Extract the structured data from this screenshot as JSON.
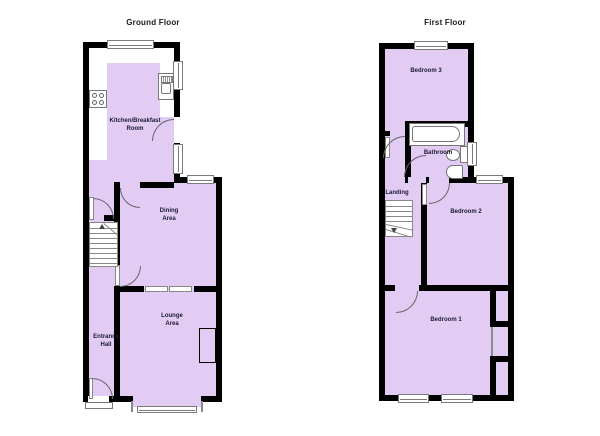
{
  "colors": {
    "room_fill": "#E3CCF3",
    "wall": "#000000",
    "fixture_outline": "#777777",
    "label_text": "#1A1A33"
  },
  "ground_floor": {
    "title": "Ground Floor",
    "rooms": {
      "kitchen": {
        "line1": "Kitchen/Breakfast",
        "line2": "Room"
      },
      "dining": {
        "line1": "Dining",
        "line2": "Area"
      },
      "lounge": {
        "line1": "Lounge",
        "line2": "Area"
      },
      "hall": {
        "line1": "Entrance",
        "line2": "Hall"
      }
    },
    "fixtures": [
      "hob",
      "sink-unit",
      "staircase",
      "bay-window",
      "entrance-door",
      "chimney-breast"
    ]
  },
  "first_floor": {
    "title": "First Floor",
    "rooms": {
      "bedroom3": {
        "line1": "Bedroom 3"
      },
      "bathroom": {
        "line1": "Bathroom"
      },
      "landing": {
        "line1": "Landing"
      },
      "bedroom2": {
        "line1": "Bedroom 2"
      },
      "bedroom1": {
        "line1": "Bedroom 1"
      }
    },
    "fixtures": [
      "bathtub",
      "toilet",
      "wash-basin",
      "staircase",
      "built-in-wardrobes"
    ]
  }
}
